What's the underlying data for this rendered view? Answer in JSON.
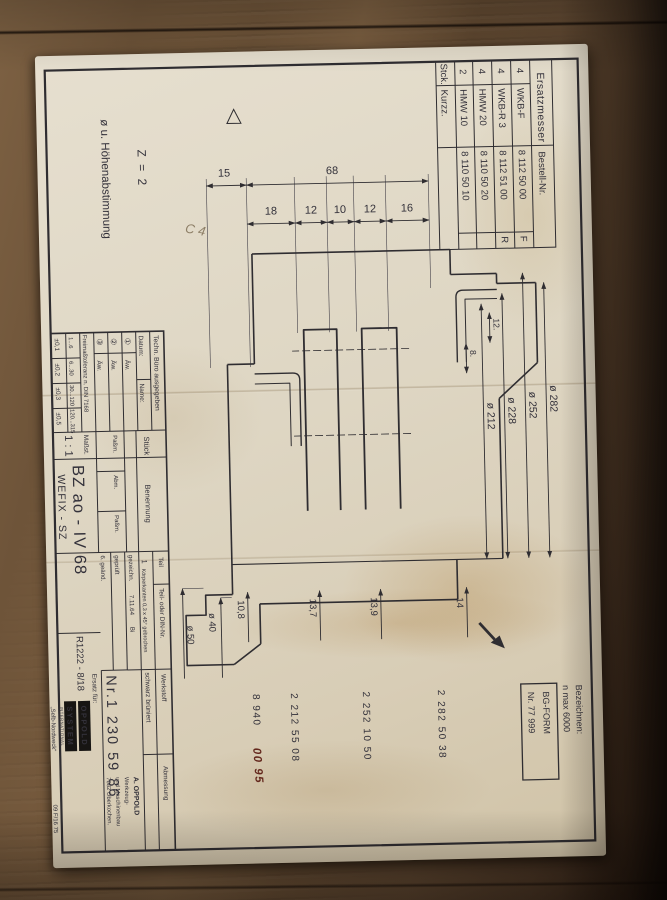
{
  "table": {
    "title": "Ersatzmesser",
    "col_stck": "Stck.",
    "col_kurzz": "Kurzz.",
    "col_bestell": "Bestell-Nr.",
    "rows": [
      {
        "stck": "4",
        "kurzz": "WKB-F",
        "nr": "8 112 50 00",
        "mark": "F"
      },
      {
        "stck": "4",
        "kurzz": "WKB-R 3",
        "nr": "8 112 51 00",
        "mark": "R"
      },
      {
        "stck": "4",
        "kurzz": "HMW 20",
        "nr": "8 110 50 20",
        "mark": ""
      },
      {
        "stck": "2",
        "kurzz": "HMW 10",
        "nr": "8 110 50 10",
        "mark": ""
      }
    ]
  },
  "bezeichnung": {
    "label": "Bezeichnen:",
    "value": "n max 6000",
    "form": "BG-FORM",
    "form_nr": "Nr. 77 999"
  },
  "orders": {
    "n1": "2 282 50 38",
    "n2": "2 252 10 50",
    "n3": "2 212 55 08",
    "n4_printed": "8 940",
    "n4_hand": "00 95"
  },
  "notes": {
    "z": "Z = 2",
    "height": "ø u. Höhenabstimmung",
    "pencil": "C 4"
  },
  "dims": {
    "d15": "15",
    "d68": "68",
    "chain": [
      "18",
      "12",
      "10",
      "12",
      "16"
    ],
    "dia282": "ø 282",
    "dia252": "ø 252",
    "dia228": "ø 228",
    "dia212": "ø 212",
    "d12": "12.",
    "d8": "8.",
    "h14": "14",
    "h139": "13,9",
    "h137": "13,7",
    "h108": "10,8",
    "dia40": "ø 40",
    "dia50": "ø 50"
  },
  "titleblock": {
    "techn_buero": "Techn. Büro ausgegeben",
    "datum": "Datum:",
    "name": "Name:",
    "rev1": "①",
    "rev2": "②",
    "rev3": "③",
    "aew": "Äw.",
    "freimass": "Freimaßtoleranz n. DIN 7168",
    "ranges": [
      "1...6",
      "6...30",
      "30...120",
      "120...315"
    ],
    "tols": [
      "±0,1",
      "±0,2",
      "±0,3",
      "±0,5"
    ],
    "stueck": "Stück",
    "benennung": "Benennung",
    "passm1": "Paßm.",
    "abm": "Abm.",
    "passm2": "Paßm.",
    "teil": "Teil",
    "teil_val": "1",
    "teil_din": "Teil- oder DIN-Nr.",
    "koerperkanten": "Körperkanten 0,3 x 45° gebrochen",
    "gezeichnet": "gezeichn.",
    "gez_datum": "7.11.64",
    "gez_name": "Bi",
    "geprueft": "geprüft",
    "geaendert": "6. geänd.",
    "werkstoff": "Werkstoff",
    "werkstoff_val": "schwarz brüniert",
    "abmessung": "Abmessung",
    "massstab": "Maßst.",
    "massstab_val": "1 : 1",
    "code": "BZ ao - IV 68",
    "name2": "WEFIX - SZ",
    "ref": "R1222 - 8/18",
    "ersatz": "Ersatz für:",
    "nr": "Nr.1 230 59 86",
    "logo_line1": "OPPOLD",
    "logo_line2": "SYSTEM",
    "logo_line3": "INTERNATIONAL",
    "company": [
      "A. OPPOLD",
      "Werkzeug-",
      "und Maschinenbau",
      "7082 Oberkochen."
    ]
  },
  "footer": {
    "mark": "„Selb-Nordweck“",
    "code": "09 F/16 75"
  }
}
